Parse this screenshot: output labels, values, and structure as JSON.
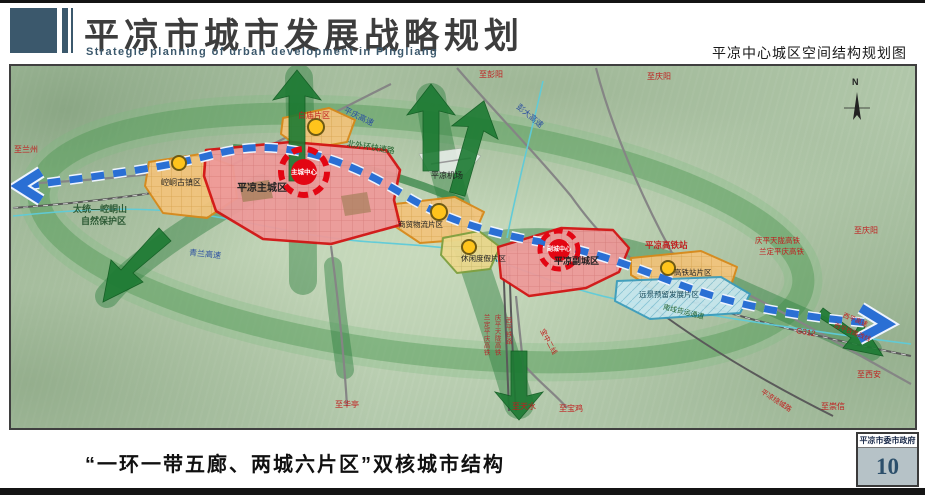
{
  "header": {
    "title": "平凉市城市发展战略规划",
    "subtitle": "Strategic planning of urban development in Pingliang",
    "map_name": "平凉中心城区空间结构规划图"
  },
  "map": {
    "compass": "N",
    "labels": {
      "to_lanzhou": "至兰州",
      "to_pengyang": "至彭阳",
      "to_qingyang_north": "至庆阳",
      "to_qingyang_east": "至庆阳",
      "to_xian": "至西安",
      "to_chongxin": "至崇信",
      "to_huating": "至华亭",
      "to_tianshui": "至天水",
      "to_baoji": "至宝鸡",
      "pengda_expressway": "彭大高速",
      "pingqing_expressway": "平庆高速",
      "qinglan_expressway": "青兰高速",
      "north_ring_expressway": "北外环快速路",
      "g312": "G312",
      "xiping_expressway": "西平高速",
      "xiping_rail_reroute": "西平铁路改线",
      "southwest_rail": "平凉绕城路",
      "baozhong_line2": "宝中二线",
      "rail_vertical_ldpq": "兰定平庆高铁",
      "rail_vertical_qptl": "庆平天陇高铁",
      "rail_vertical_xiping": "西平铁路",
      "hsr_east_line1": "庆平天陇高铁",
      "hsr_east_line2": "兰定平庆高铁",
      "south_freight_corridor": "南线货运通道",
      "airport": "平凉机场",
      "hsr_station": "平凉高铁站",
      "nature_reserve_line1": "太统—崆峒山",
      "nature_reserve_line2": "自然保护区",
      "main_city": "平凉主城区",
      "sub_city": "平凉副城区",
      "main_center": "主城中心",
      "sub_center": "副城中心",
      "zone_kongtong": "崆峒古镇区",
      "zone_baimiao": "白庙片区",
      "zone_trade": "商贸物流片区",
      "zone_leisure": "休闲度假片区",
      "zone_hsr": "高铁站片区",
      "zone_reserved": "远景预留发展片区"
    },
    "colors": {
      "city_zone_red": "#d31313",
      "district_orange": "#d8891a",
      "axis_blue": "#2a6fd4",
      "corridor_green": "#1c7a33",
      "reserved_cyan": "#3a9cbe"
    }
  },
  "footer": {
    "caption": "“一环一带五廊、两城六片区”双核城市结构",
    "org": "平凉市委市政府",
    "page": "10"
  }
}
